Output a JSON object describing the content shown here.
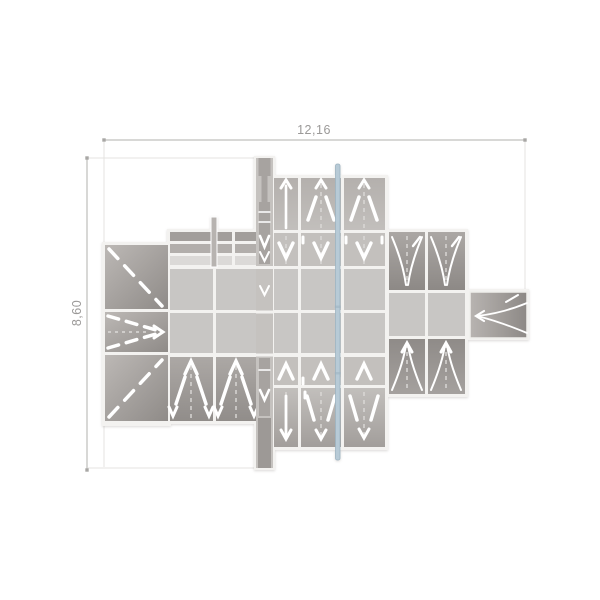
{
  "page": {
    "background": "#ffffff"
  },
  "drawing": {
    "type": "architectural-plan-top-view",
    "annotations": {
      "width_dimension": "12,16",
      "height_dimension": "8,60"
    },
    "style": {
      "dimension_text_color": "#9b9998",
      "dimension_line_color": "#b2b0ae",
      "witness_line_color": "#e4e3e1",
      "panel_light": "#c8c6c4",
      "panel_medium": "#bdb9b6",
      "panel_dark": "#948f8c",
      "gridline_color": "#f3f2f0",
      "slope_mark_color": "#ffffff",
      "section_line_fill": "#b7cad6",
      "section_line_edge": "#9db3c1"
    },
    "elements": [
      "hip-roof-block",
      "louver-canopy",
      "support-pole",
      "flat-roof-grid",
      "upper-roof-wing",
      "lower-roof-wing",
      "bottom-left-roof-cells",
      "side-roof-wing",
      "barrel-roof-extension",
      "roof-mast-strip",
      "section-line",
      "width-dimension",
      "height-dimension"
    ]
  }
}
